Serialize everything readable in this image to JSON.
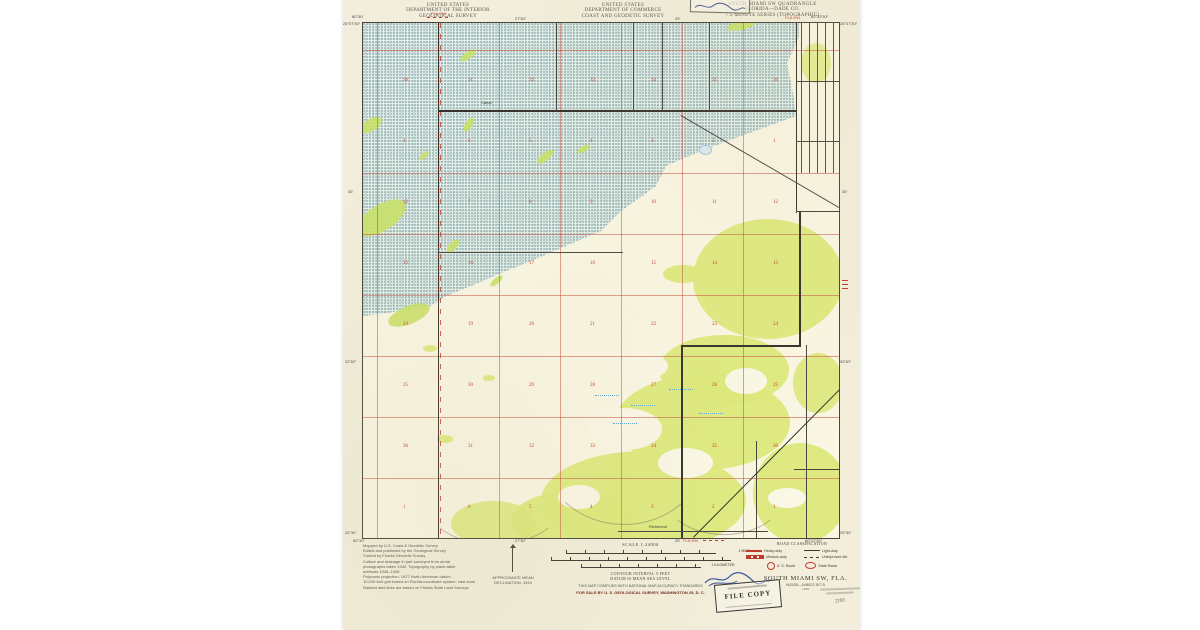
{
  "header": {
    "left": {
      "line1": "UNITED STATES",
      "line2": "DEPARTMENT OF THE INTERIOR",
      "line3": "GEOLOGICAL SURVEY"
    },
    "center": {
      "line1": "UNITED STATES",
      "line2": "DEPARTMENT OF COMMERCE",
      "line3": "COAST AND GEODETIC SURVEY"
    },
    "right": {
      "line1": "SOUTH MIAMI SW QUADRANGLE",
      "line2": "FLORIDA—DADE CO.",
      "line3": "7.5 MINUTE SERIES (TOPOGRAPHIC)"
    },
    "road_ref_top": "FLA 994",
    "road_ref_right": "FLA 994",
    "road_ref_bottom": "FLA 994"
  },
  "map": {
    "corner_coords": {
      "top_left_lon": "80°30′",
      "top_left_lat": "25°37′30″",
      "top_right_lon": "80°22′30″",
      "top_right_lat": "25°37′30″",
      "bottom_left_lat": "25°30′",
      "bottom_left_lon": "80°30′",
      "bottom_right_lon": "80°22′30″",
      "bottom_right_lat": "25°30′"
    },
    "edge_ticks": {
      "top_a": "27′30″",
      "top_b": "25′",
      "left_a": "35′",
      "left_b": "32′30″",
      "right_a": "35′",
      "right_b": "32′30″",
      "bottom_a": "27′30″",
      "bottom_b": "25′"
    },
    "labels": {
      "canal": "Canal",
      "richmond": "Richmond"
    },
    "section_numbers": [
      {
        "y": 55,
        "left": "36",
        "values": [
          "31",
          "32",
          "33",
          "34",
          "35",
          "36"
        ]
      },
      {
        "y": 116,
        "left": "1",
        "values": [
          "6",
          "5",
          "4",
          "3",
          "2",
          "1"
        ]
      },
      {
        "y": 177,
        "left": "12",
        "values": [
          "7",
          "8",
          "9",
          "10",
          "11",
          "12"
        ]
      },
      {
        "y": 238,
        "left": "13",
        "values": [
          "18",
          "17",
          "16",
          "15",
          "14",
          "13"
        ]
      },
      {
        "y": 299,
        "left": "24",
        "values": [
          "19",
          "20",
          "21",
          "22",
          "23",
          "24"
        ]
      },
      {
        "y": 360,
        "left": "25",
        "values": [
          "30",
          "29",
          "28",
          "27",
          "26",
          "25"
        ]
      },
      {
        "y": 421,
        "left": "36",
        "values": [
          "31",
          "32",
          "33",
          "34",
          "35",
          "36"
        ]
      },
      {
        "y": 482,
        "left": "1",
        "values": [
          "6",
          "5",
          "4",
          "3",
          "2",
          "1"
        ]
      }
    ],
    "colors": {
      "swamp_stipple": "#376c80",
      "vegetation": "#dce97b",
      "grid_red": "#c94f3f",
      "line_black": "#35322b"
    }
  },
  "footer": {
    "credits": [
      "Mapped by U.S. Coast & Geodetic Survey",
      "Edited and published by the Geological Survey",
      "Control by Florida Geodetic Survey",
      "Culture and drainage in part surveyed from aerial",
      "photographs taken 1940. Topography by plane-table",
      "methods 1945–1946",
      "Polyconic projection. 1927 North American datum",
      "10,000-foot grid based on Florida coordinate system, east zone",
      "Dashed land lines are based on Florida State Land Surveys"
    ],
    "declination": {
      "line1": "APPROXIMATE MEAN",
      "line2": "DECLINATION, 1949"
    },
    "scale": {
      "title": "SCALE 1:24000",
      "bar1_right": "1 MILE",
      "bar2_right": "7000 FEET",
      "bar3_right": "1 KILOMETER",
      "contour": "CONTOUR INTERVAL 5 FEET",
      "datum": "DATUM IS MEAN SEA LEVEL"
    },
    "accuracy": "THIS MAP COMPLIES WITH NATIONAL MAP ACCURACY STANDARDS",
    "sale": "FOR SALE BY U. S. GEOLOGICAL SURVEY, WASHINGTON 25, D. C.",
    "road_class": {
      "title": "ROAD CLASSIFICATION",
      "heavy": "Heavy-duty",
      "medium": "Medium-duty",
      "light": "Light-duty",
      "unimproved": "Unimproved dirt",
      "us_route": "U. S. Route",
      "state_route": "State Route"
    },
    "title_block": {
      "name": "SOUTH MIAMI SW, FLA.",
      "ref": "N2530—W8022.5/7.5",
      "year": "1949"
    },
    "stamps": {
      "file_copy": "FILE COPY",
      "number": "2193"
    }
  }
}
